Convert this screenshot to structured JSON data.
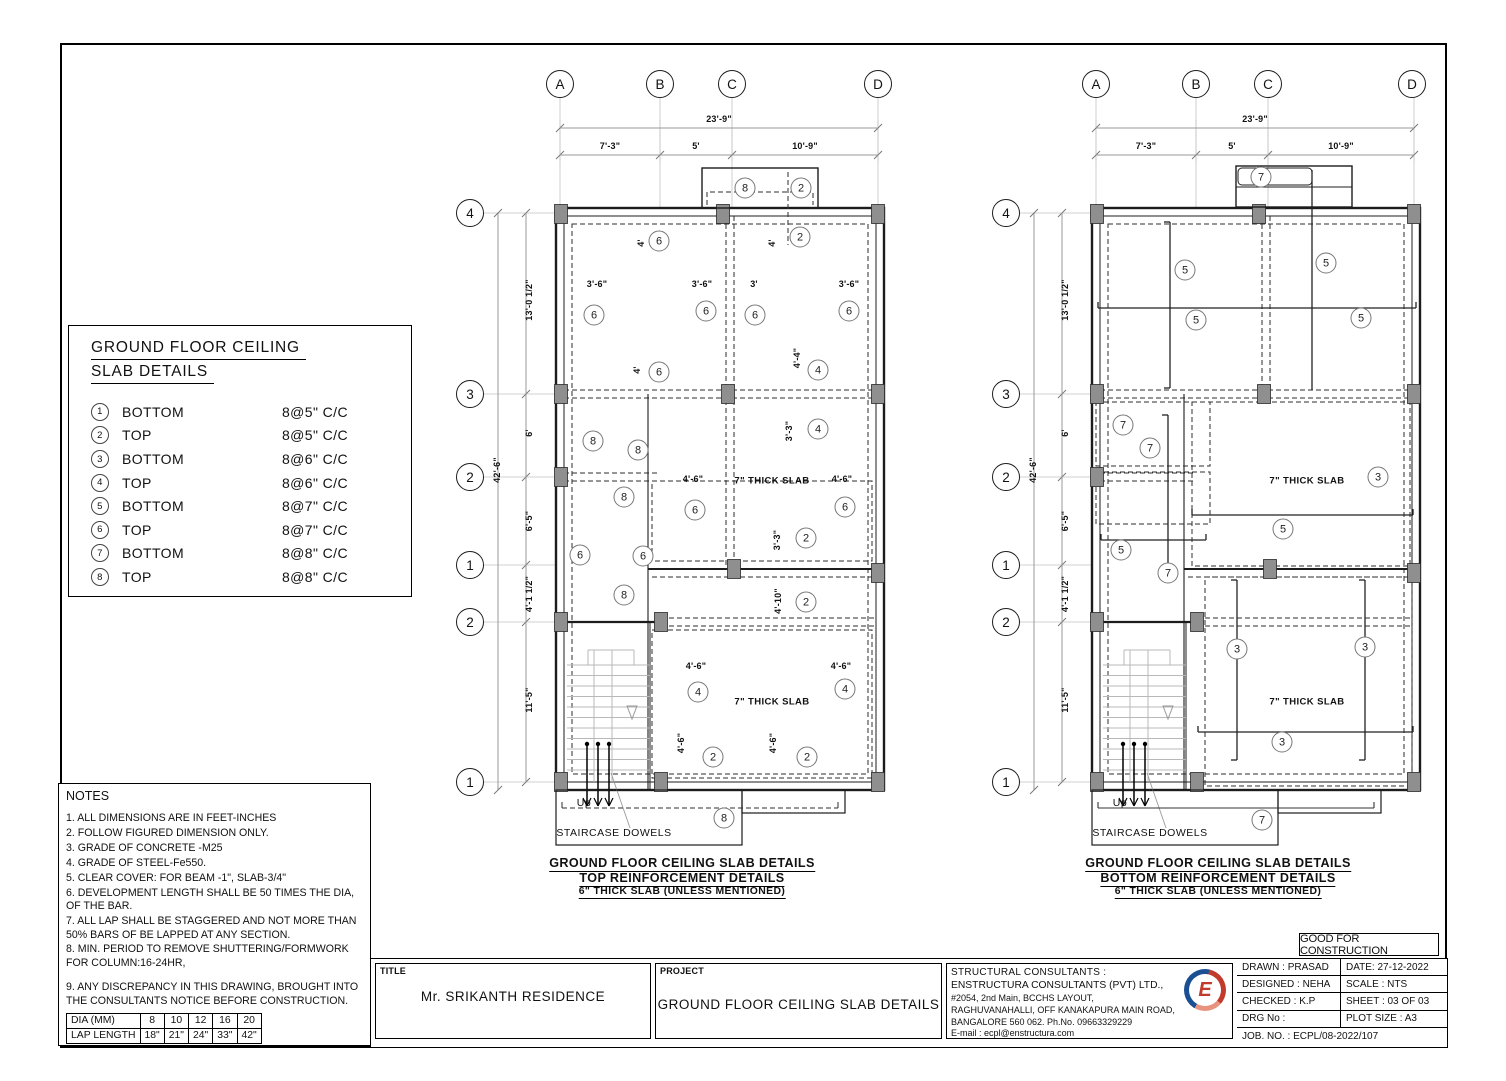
{
  "stamp": "GOOD FOR CONSTRUCTION",
  "legend": {
    "title_line1": "GROUND FLOOR CEILING",
    "title_line2": "SLAB DETAILS",
    "items": [
      {
        "num": "1",
        "pos": "BOTTOM",
        "spec": "8@5\" C/C"
      },
      {
        "num": "2",
        "pos": "TOP",
        "spec": "8@5\" C/C"
      },
      {
        "num": "3",
        "pos": "BOTTOM",
        "spec": "8@6\" C/C"
      },
      {
        "num": "4",
        "pos": "TOP",
        "spec": "8@6\" C/C"
      },
      {
        "num": "5",
        "pos": "BOTTOM",
        "spec": "8@7\" C/C"
      },
      {
        "num": "6",
        "pos": "TOP",
        "spec": "8@7\" C/C"
      },
      {
        "num": "7",
        "pos": "BOTTOM",
        "spec": "8@8\" C/C"
      },
      {
        "num": "8",
        "pos": "TOP",
        "spec": "8@8\" C/C"
      }
    ]
  },
  "notes": {
    "title": "NOTES",
    "items": [
      "1. ALL DIMENSIONS ARE IN FEET-INCHES",
      "2. FOLLOW FIGURED DIMENSION ONLY.",
      "3. GRADE OF CONCRETE -M25",
      "4. GRADE OF STEEL-Fe550.",
      "5. CLEAR COVER: FOR BEAM -1\", SLAB-3/4\"",
      "6. DEVELOPMENT LENGTH  SHALL BE 50 TIMES THE DIA, OF THE BAR.",
      "7. ALL LAP SHALL BE STAGGERED AND NOT MORE THAN   50% BARS OF  BE LAPPED AT ANY SECTION.",
      "8. MIN. PERIOD TO REMOVE SHUTTERING/FORMWORK FOR COLUMN:16-24HR,",
      "9. ANY DISCREPANCY IN THIS DRAWING, BROUGHT INTO THE CONSULTANTS NOTICE BEFORE CONSTRUCTION."
    ],
    "lap_table": [
      [
        "DIA (MM)",
        "8",
        "10",
        "12",
        "16",
        "20"
      ],
      [
        "LAP LENGTH",
        "18\"",
        "21\"",
        "24\"",
        "33\"",
        "42\""
      ]
    ]
  },
  "title_block": {
    "title_label": "TITLE",
    "title": "Mr. SRIKANTH RESIDENCE",
    "project_label": "PROJECT",
    "project": "GROUND FLOOR CEILING SLAB DETAILS",
    "consultants": [
      "STRUCTURAL CONSULTANTS :",
      "ENSTRUCTURA CONSULTANTS (PVT) LTD.,",
      "#2054, 2nd Main, BCCHS LAYOUT,",
      "RAGHUVANAHALLI, OFF KANAKAPURA MAIN ROAD,",
      "BANGALORE 560 062. Ph.No. 09663329229",
      "E-mail : ecpl@enstructura.com"
    ],
    "logo_letter": "E",
    "field_rows": [
      {
        "left": "DRAWN : PRASAD",
        "right": "DATE: 27-12-2022"
      },
      {
        "left": "DESIGNED : NEHA",
        "right": "SCALE :  NTS"
      },
      {
        "left": "CHECKED :  K.P",
        "right": "SHEET :  03 OF 03"
      },
      {
        "left": "DRG No :",
        "right": "PLOT SIZE :   A3"
      },
      {
        "left": "JOB. NO. : ECPL/08-2022/107",
        "right": null
      }
    ]
  },
  "plans": [
    {
      "name": "top-reinforcement",
      "dx": 0,
      "variant": "top",
      "row_circle_x": 470,
      "cols": [
        {
          "label": "A",
          "x": 560
        },
        {
          "label": "B",
          "x": 660
        },
        {
          "label": "C",
          "x": 732
        },
        {
          "label": "D",
          "x": 878
        }
      ],
      "rows": [
        {
          "label": "4",
          "y": 213
        },
        {
          "label": "3",
          "y": 394
        },
        {
          "label": "2",
          "y": 477
        },
        {
          "label": "1",
          "y": 565
        },
        {
          "label": "2",
          "y": 622
        },
        {
          "label": "1",
          "y": 782
        }
      ],
      "top_dims": {
        "overall": {
          "v": "23'-9\"",
          "x": 719,
          "y": 119
        },
        "segs": [
          {
            "v": "7'-3\"",
            "x": 610,
            "y": 146
          },
          {
            "v": "5'",
            "x": 696,
            "y": 146
          },
          {
            "v": "10'-9\"",
            "x": 805,
            "y": 146
          }
        ]
      },
      "left_dims": {
        "overall": {
          "v": "42'-6\"",
          "x": 497,
          "y": 470
        },
        "segs": [
          {
            "v": "13'-0 1/2\"",
            "x": 529,
            "y": 300
          },
          {
            "v": "6'",
            "x": 529,
            "y": 433
          },
          {
            "v": "6'-5\"",
            "x": 529,
            "y": 521
          },
          {
            "v": "4'-1 1/2\"",
            "x": 529,
            "y": 594
          },
          {
            "v": "11'-5\"",
            "x": 529,
            "y": 700
          }
        ]
      },
      "annotations": [
        {
          "t": "c",
          "n": "8",
          "x": 745,
          "y": 188
        },
        {
          "t": "c",
          "n": "2",
          "x": 801,
          "y": 188
        },
        {
          "t": "dv",
          "v": "4'",
          "x": 641,
          "y": 243
        },
        {
          "t": "c",
          "n": "6",
          "x": 659,
          "y": 241
        },
        {
          "t": "dv",
          "v": "4'",
          "x": 772,
          "y": 243
        },
        {
          "t": "c",
          "n": "2",
          "x": 800,
          "y": 237
        },
        {
          "t": "d",
          "v": "3'-6\"",
          "x": 597,
          "y": 284
        },
        {
          "t": "d",
          "v": "3'-6\"",
          "x": 702,
          "y": 284
        },
        {
          "t": "d",
          "v": "3'",
          "x": 754,
          "y": 284
        },
        {
          "t": "d",
          "v": "3'-6\"",
          "x": 849,
          "y": 284
        },
        {
          "t": "c",
          "n": "6",
          "x": 594,
          "y": 315
        },
        {
          "t": "c",
          "n": "6",
          "x": 706,
          "y": 311
        },
        {
          "t": "c",
          "n": "6",
          "x": 755,
          "y": 315
        },
        {
          "t": "c",
          "n": "6",
          "x": 849,
          "y": 311
        },
        {
          "t": "dv",
          "v": "4'",
          "x": 637,
          "y": 370
        },
        {
          "t": "c",
          "n": "6",
          "x": 659,
          "y": 372
        },
        {
          "t": "dv",
          "v": "4'-4\"",
          "x": 797,
          "y": 358
        },
        {
          "t": "c",
          "n": "4",
          "x": 818,
          "y": 370
        },
        {
          "t": "dv",
          "v": "3'-3\"",
          "x": 789,
          "y": 431
        },
        {
          "t": "c",
          "n": "4",
          "x": 818,
          "y": 429
        },
        {
          "t": "c",
          "n": "8",
          "x": 593,
          "y": 441
        },
        {
          "t": "c",
          "n": "8",
          "x": 638,
          "y": 450
        },
        {
          "t": "c",
          "n": "8",
          "x": 624,
          "y": 497
        },
        {
          "t": "d",
          "v": "4'-6\"",
          "x": 693,
          "y": 479
        },
        {
          "t": "l",
          "v": "7\" THICK SLAB",
          "x": 772,
          "y": 481
        },
        {
          "t": "d",
          "v": "4'-6\"",
          "x": 842,
          "y": 479
        },
        {
          "t": "c",
          "n": "6",
          "x": 695,
          "y": 510
        },
        {
          "t": "c",
          "n": "6",
          "x": 845,
          "y": 507
        },
        {
          "t": "dv",
          "v": "3'-3\"",
          "x": 777,
          "y": 540
        },
        {
          "t": "c",
          "n": "2",
          "x": 806,
          "y": 538
        },
        {
          "t": "c",
          "n": "6",
          "x": 580,
          "y": 555
        },
        {
          "t": "c",
          "n": "6",
          "x": 643,
          "y": 556
        },
        {
          "t": "c",
          "n": "8",
          "x": 624,
          "y": 595
        },
        {
          "t": "dv",
          "v": "4'-10\"",
          "x": 778,
          "y": 601
        },
        {
          "t": "c",
          "n": "2",
          "x": 806,
          "y": 602
        },
        {
          "t": "d",
          "v": "4'-6\"",
          "x": 696,
          "y": 666
        },
        {
          "t": "d",
          "v": "4'-6\"",
          "x": 841,
          "y": 666
        },
        {
          "t": "c",
          "n": "4",
          "x": 698,
          "y": 692
        },
        {
          "t": "l",
          "v": "7\" THICK SLAB",
          "x": 772,
          "y": 702
        },
        {
          "t": "c",
          "n": "4",
          "x": 845,
          "y": 689
        },
        {
          "t": "dv",
          "v": "4'-6\"",
          "x": 681,
          "y": 743
        },
        {
          "t": "c",
          "n": "2",
          "x": 713,
          "y": 757
        },
        {
          "t": "dv",
          "v": "4'-6\"",
          "x": 773,
          "y": 743
        },
        {
          "t": "c",
          "n": "2",
          "x": 807,
          "y": 757
        },
        {
          "t": "c",
          "n": "8",
          "x": 724,
          "y": 818
        },
        {
          "t": "s",
          "v": "Up",
          "x": 584,
          "y": 803
        },
        {
          "t": "s",
          "v": "STAIRCASE DOWELS",
          "x": 614,
          "y": 833
        }
      ],
      "captions": [
        "GROUND FLOOR CEILING SLAB DETAILS",
        "TOP REINFORCEMENT DETAILS",
        "6\" THICK SLAB (UNLESS MENTIONED)"
      ],
      "caption_x": 682,
      "caption_y": 856
    },
    {
      "name": "bottom-reinforcement",
      "dx": 536,
      "variant": "bottom",
      "row_circle_x": 1006,
      "cols": [
        {
          "label": "A",
          "x": 1096
        },
        {
          "label": "B",
          "x": 1196
        },
        {
          "label": "C",
          "x": 1268
        },
        {
          "label": "D",
          "x": 1412
        }
      ],
      "rows": [
        {
          "label": "4",
          "y": 213
        },
        {
          "label": "3",
          "y": 394
        },
        {
          "label": "2",
          "y": 477
        },
        {
          "label": "1",
          "y": 565
        },
        {
          "label": "2",
          "y": 622
        },
        {
          "label": "1",
          "y": 782
        }
      ],
      "top_dims": {
        "overall": {
          "v": "23'-9\"",
          "x": 1255,
          "y": 119
        },
        "segs": [
          {
            "v": "7'-3\"",
            "x": 1146,
            "y": 146
          },
          {
            "v": "5'",
            "x": 1232,
            "y": 146
          },
          {
            "v": "10'-9\"",
            "x": 1341,
            "y": 146
          }
        ]
      },
      "left_dims": {
        "overall": {
          "v": "42'-6\"",
          "x": 1033,
          "y": 470
        },
        "segs": [
          {
            "v": "13'-0 1/2\"",
            "x": 1065,
            "y": 300
          },
          {
            "v": "6'",
            "x": 1065,
            "y": 433
          },
          {
            "v": "6'-5\"",
            "x": 1065,
            "y": 521
          },
          {
            "v": "4'-1 1/2\"",
            "x": 1065,
            "y": 594
          },
          {
            "v": "11'-5\"",
            "x": 1065,
            "y": 700
          }
        ]
      },
      "annotations": [
        {
          "t": "c",
          "n": "7",
          "x": 1261,
          "y": 177
        },
        {
          "t": "c",
          "n": "5",
          "x": 1185,
          "y": 270
        },
        {
          "t": "c",
          "n": "5",
          "x": 1326,
          "y": 263
        },
        {
          "t": "c",
          "n": "5",
          "x": 1196,
          "y": 320
        },
        {
          "t": "c",
          "n": "5",
          "x": 1361,
          "y": 318
        },
        {
          "t": "c",
          "n": "7",
          "x": 1123,
          "y": 425
        },
        {
          "t": "c",
          "n": "7",
          "x": 1150,
          "y": 448
        },
        {
          "t": "l",
          "v": "7\" THICK SLAB",
          "x": 1307,
          "y": 481
        },
        {
          "t": "c",
          "n": "3",
          "x": 1378,
          "y": 477
        },
        {
          "t": "c",
          "n": "5",
          "x": 1283,
          "y": 529
        },
        {
          "t": "c",
          "n": "5",
          "x": 1121,
          "y": 550
        },
        {
          "t": "c",
          "n": "7",
          "x": 1168,
          "y": 573
        },
        {
          "t": "c",
          "n": "3",
          "x": 1237,
          "y": 649
        },
        {
          "t": "c",
          "n": "3",
          "x": 1365,
          "y": 647
        },
        {
          "t": "l",
          "v": "7\" THICK SLAB",
          "x": 1307,
          "y": 702
        },
        {
          "t": "c",
          "n": "3",
          "x": 1282,
          "y": 742
        },
        {
          "t": "c",
          "n": "7",
          "x": 1262,
          "y": 820
        },
        {
          "t": "s",
          "v": "Up",
          "x": 1120,
          "y": 803
        },
        {
          "t": "s",
          "v": "STAIRCASE DOWELS",
          "x": 1150,
          "y": 833
        }
      ],
      "captions": [
        "GROUND FLOOR CEILING SLAB DETAILS",
        "BOTTOM REINFORCEMENT DETAILS",
        "6\" THICK SLAB (UNLESS MENTIONED)"
      ],
      "caption_x": 1218,
      "caption_y": 856
    }
  ]
}
